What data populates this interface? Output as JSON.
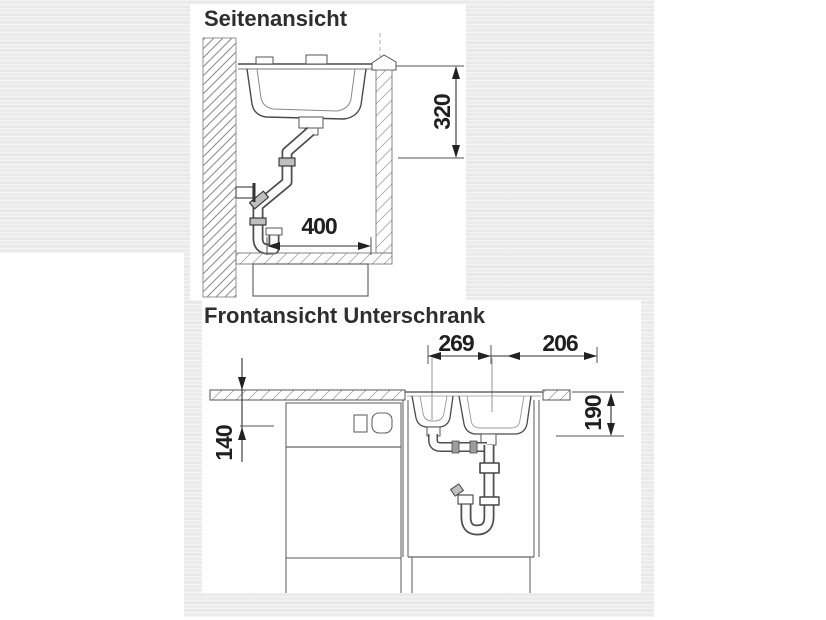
{
  "colors": {
    "photo_background": "#ececec",
    "panel_background": "#ffffff",
    "line": "#4a4a4a",
    "label_text": "#1f1f1f"
  },
  "side_view": {
    "title": "Seitenansicht",
    "dims": {
      "height": "320",
      "width": "400"
    }
  },
  "front_view": {
    "title": "Frontansicht Unterschrank",
    "dims": {
      "bowl_offset_left": "269",
      "bowl_offset_right": "206",
      "height_left": "140",
      "bowl_depth": "190"
    }
  }
}
